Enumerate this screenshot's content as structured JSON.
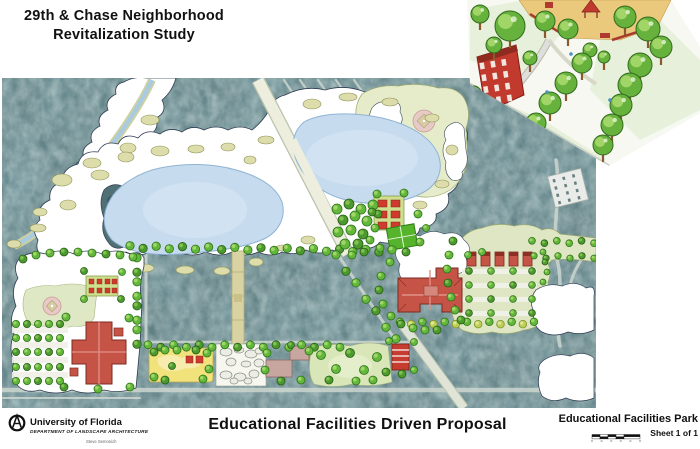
{
  "header": {
    "title_line1": "29th & Chase Neighborhood",
    "title_line2": "Revitalization Study"
  },
  "footer": {
    "institution": {
      "name": "University of Florida",
      "department": "DEPARTMENT OF LANDSCAPE ARCHITECTURE",
      "author": "Steve Semonich"
    },
    "proposal_title": "Educational Facilities Driven Proposal",
    "title_block": {
      "sheet_title": "Educational Facilities Park",
      "sheet_number": "Sheet 1 of 1"
    }
  },
  "colors": {
    "aerial_base": "#5d7c80",
    "forest_dark": "#3a585e",
    "lake_blue": "#c6dcee",
    "overlay_white": "#ffffff",
    "park_green": "#e6ecca",
    "khaki": "#dddcab",
    "tree_green": "#63b73a",
    "tree_dark": "#4c9a2f",
    "tree_yellow": "#bcd055",
    "building_red": "#c55447",
    "bright_red": "#cc3b2e",
    "diamond_pink": "#e7c9c5",
    "path_tan": "#d9d3a4",
    "playground_yellow": "#f2e27c",
    "plaza_orange": "#eac87c",
    "mauve": "#c7a6a0",
    "court_green": "#55b32c"
  }
}
